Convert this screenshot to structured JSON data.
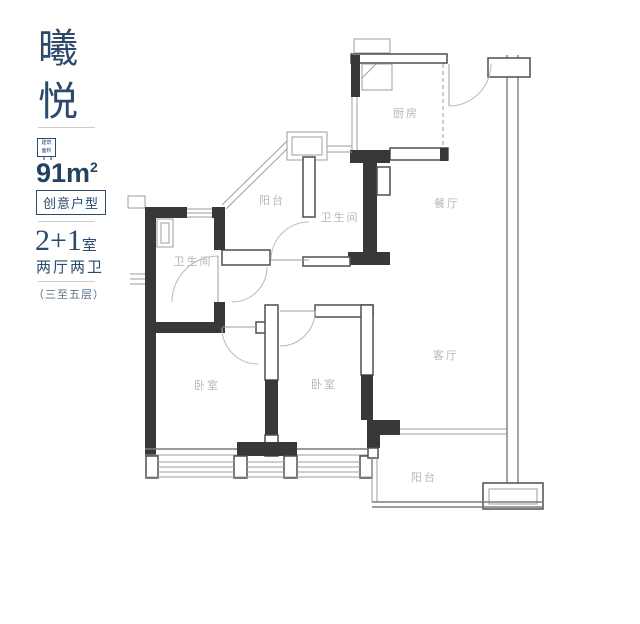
{
  "sidebar": {
    "title_char1": "曦",
    "title_char2": "悦",
    "badge_line1": "建筑",
    "badge_line2": "面积",
    "area_number": "91m",
    "area_sup": "2",
    "type_tag": "创意户型",
    "layout_number": "2+1",
    "layout_unit": "室",
    "layout_detail": "两厅两卫",
    "floor_range": "（三至五层）"
  },
  "floorplan": {
    "rooms": [
      {
        "id": "kitchen",
        "label": "厨房"
      },
      {
        "id": "dining",
        "label": "餐厅"
      },
      {
        "id": "balcony-top",
        "label": "阳台"
      },
      {
        "id": "bath-center",
        "label": "卫生间"
      },
      {
        "id": "bath-left",
        "label": "卫生间"
      },
      {
        "id": "bedroom-left",
        "label": "卧室"
      },
      {
        "id": "bedroom-center",
        "label": "卧室"
      },
      {
        "id": "living",
        "label": "客厅"
      },
      {
        "id": "balcony-bottom",
        "label": "阳台"
      }
    ]
  },
  "colors": {
    "accent": "#2b4a6b",
    "area_text": "#24415f",
    "wall": "#383838",
    "room_label": "#b8b8b8",
    "divider": "#cccccc"
  }
}
